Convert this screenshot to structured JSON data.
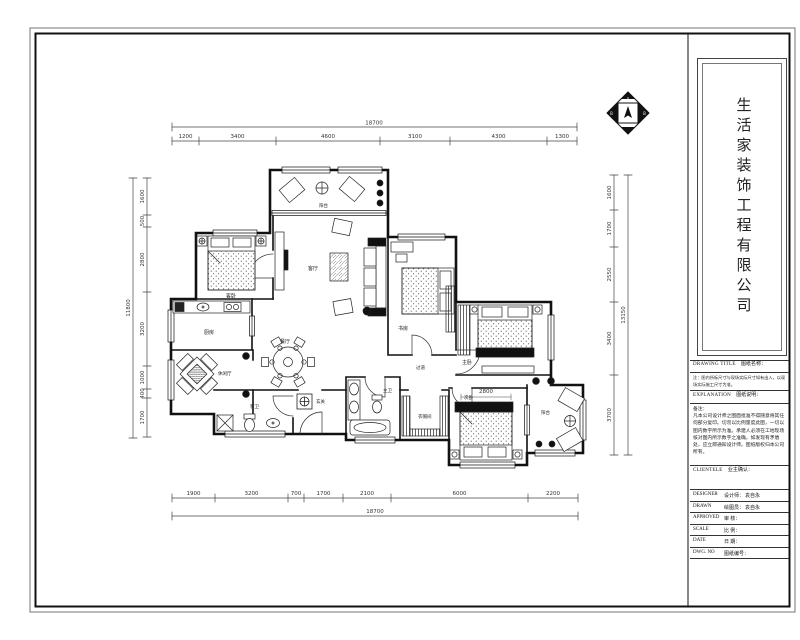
{
  "company": {
    "name": "生活家装饰工程有限公司"
  },
  "title_block": {
    "drawing_title": {
      "en": "DRAWING TITLE",
      "zh": "图纸名称："
    },
    "note_line1": "注：图内所标尺寸与现场实际尺寸如有出入，以现",
    "note_line2": "场实际施工尺寸为准。",
    "explanation": {
      "en": "EXPLANATION",
      "zh": "图纸说明："
    },
    "remark_title": "备注：",
    "remark_body": "凡本公司设计师之图面批准不得随意将其任何部分复印。切勿以比例量度此图，一切以图内数字所示为准。承建人必须在工地现场核对图内所示数字之准确，如发现有矛盾处，应立即通知设计师。图纸版权归本公司所有。",
    "clientele": {
      "en": "CLIENTELE",
      "zh": "业主确认："
    },
    "rows": [
      {
        "en": "DESIGNER",
        "zh": "设计师：",
        "value": "袁自永"
      },
      {
        "en": "DRAWN",
        "zh": "绘图员：",
        "value": "袁自永"
      },
      {
        "en": "APPROVED",
        "zh": "审  核：",
        "value": ""
      },
      {
        "en": "SCALE",
        "zh": "比  例：",
        "value": ""
      },
      {
        "en": "DATE",
        "zh": "日  期：",
        "value": ""
      },
      {
        "en": "DWG. NO",
        "zh": "图纸编号：",
        "value": ""
      }
    ]
  },
  "dimensions": {
    "top": {
      "total": "18700",
      "segments": [
        "1200",
        "3400",
        "4600",
        "3100",
        "4300",
        "1300"
      ]
    },
    "bottom": {
      "total": "18700",
      "segments": [
        "1900",
        "3200",
        "700",
        "1700",
        "2100",
        "6000",
        "2200"
      ]
    },
    "left": {
      "total": "11800",
      "segments": [
        "1600",
        "500",
        "2800",
        "3200",
        "1000",
        "400",
        "1700"
      ]
    },
    "right": {
      "total": "13150",
      "segments": [
        "1600",
        "1700",
        "2550",
        "3400",
        "3700"
      ]
    }
  },
  "rooms": {
    "balcony_top": "阳台",
    "guest_bedroom": "客卧",
    "kitchen": "厨房",
    "tea_room": "休闲厅",
    "guest_bath": "客卫",
    "entry": "玄关",
    "dining": "餐厅",
    "living": "客厅",
    "study": "书房",
    "master_bedroom": "主卧",
    "second_bedroom": "次卧",
    "master_bath": "主卫",
    "closet": "衣帽间",
    "corridor": "过道",
    "balcony_br": "阳台",
    "kids_bed_dim": "2800"
  },
  "compass": {
    "top": "A",
    "left": "B",
    "right": "B"
  }
}
